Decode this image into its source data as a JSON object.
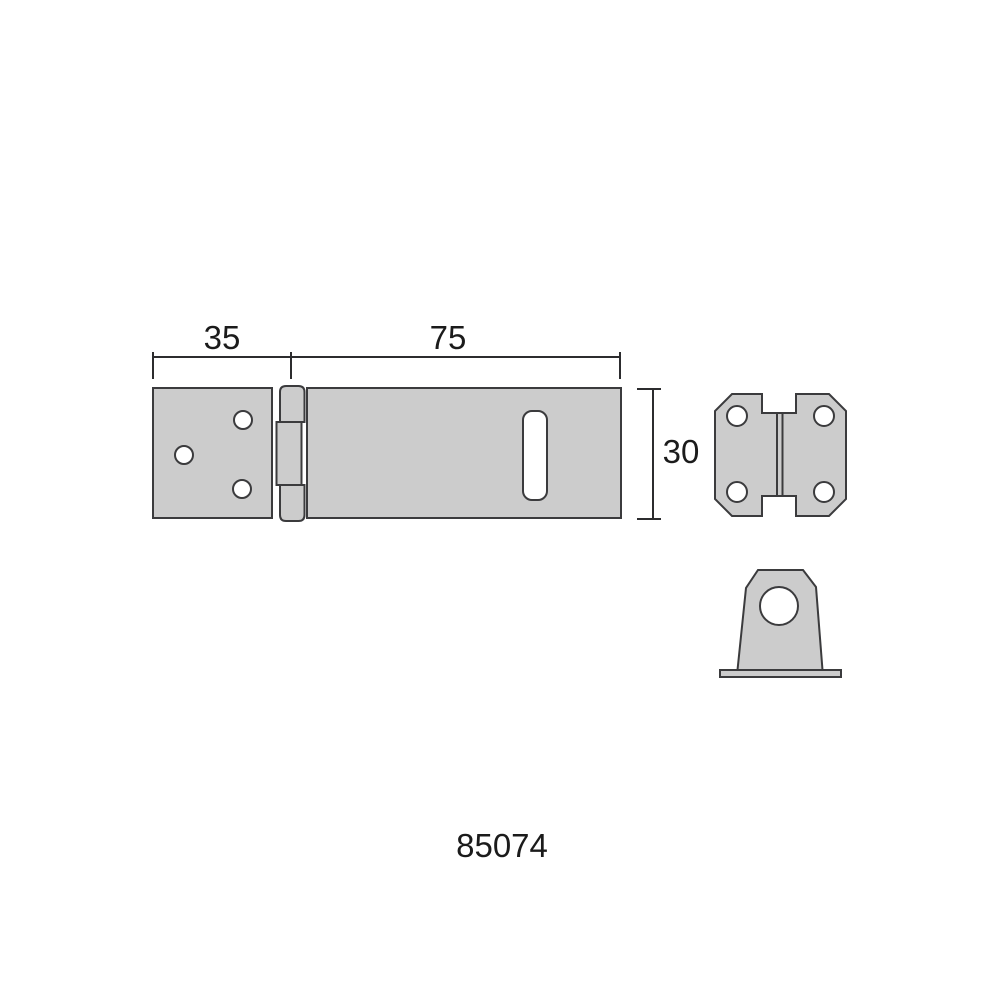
{
  "page": {
    "background": "#ffffff"
  },
  "drawing": {
    "part_number": "85074",
    "dimensions": {
      "leaf_width_mm": "35",
      "hasp_length_mm": "75",
      "plate_height_mm": "30"
    },
    "colors": {
      "page-bg": "#ffffff",
      "metal-fill": "#cccccc",
      "hole-fill": "#ffffff",
      "outline": "#3b3b3d",
      "dimension": "#2c2c2e",
      "text": "#1b1b1b"
    }
  }
}
